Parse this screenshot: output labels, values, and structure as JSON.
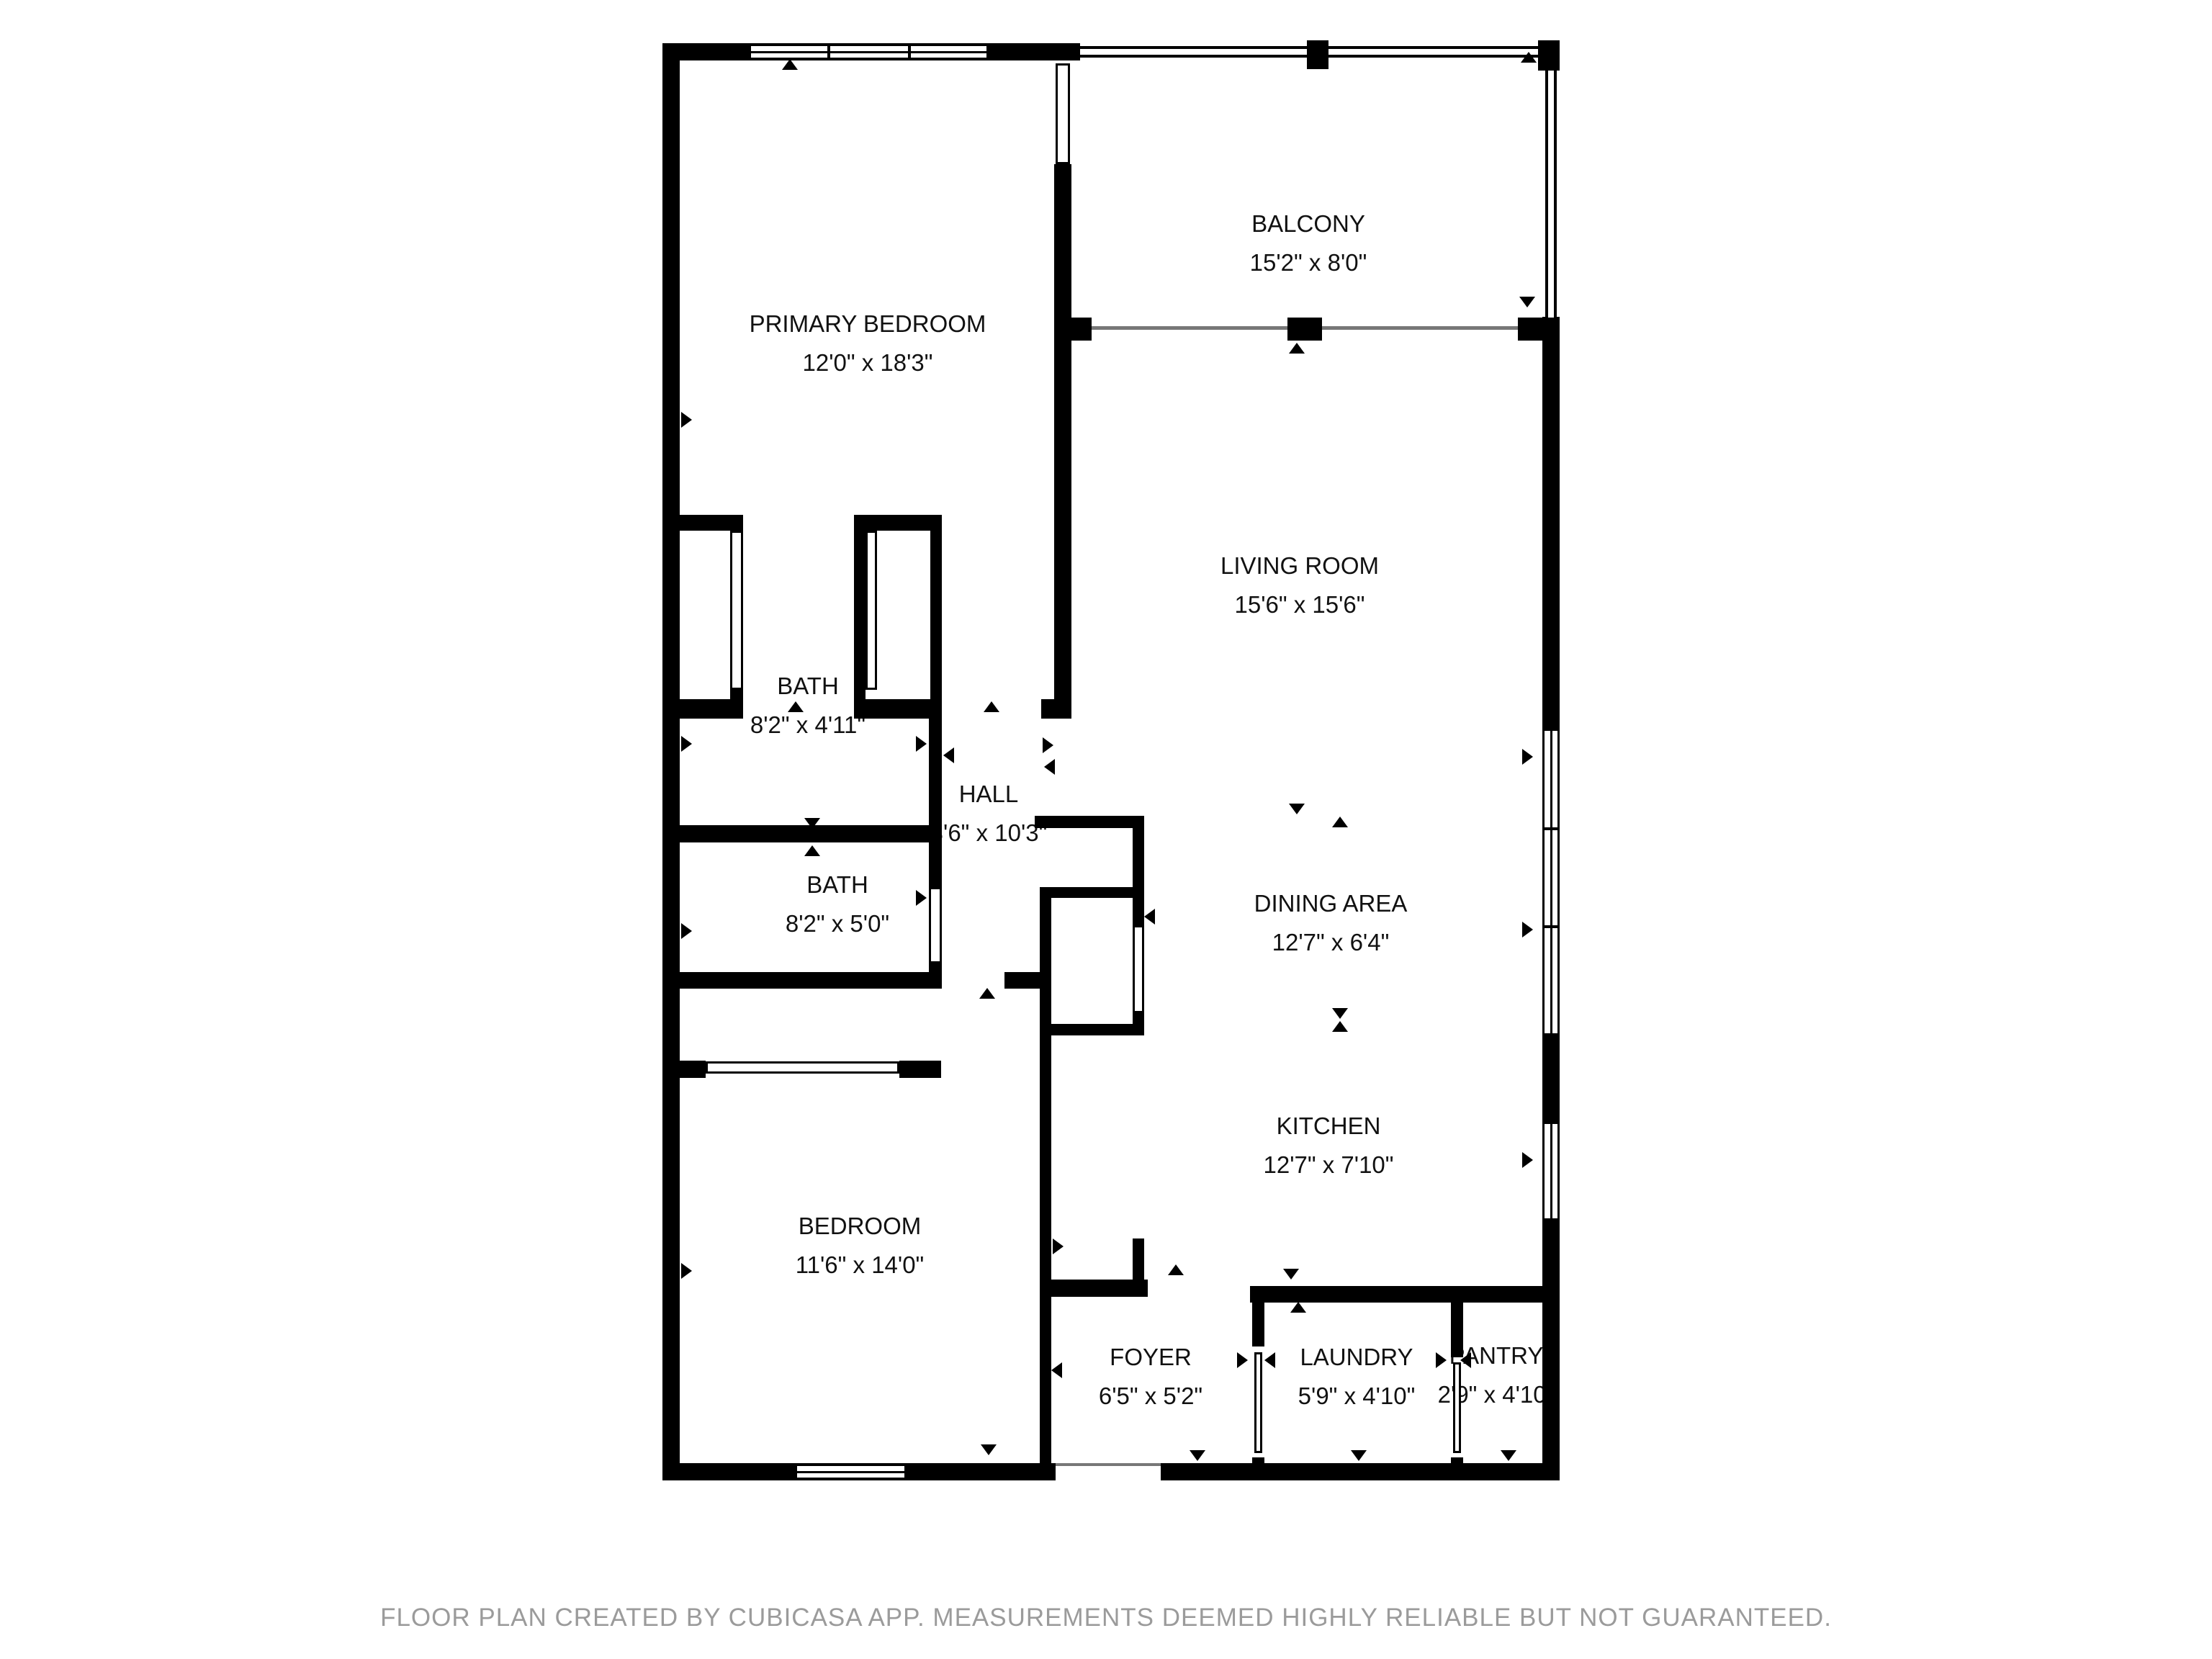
{
  "floor_plan": {
    "footer": "FLOOR PLAN CREATED BY CUBICASA APP. MEASUREMENTS DEEMED HIGHLY RELIABLE BUT NOT GUARANTEED.",
    "colors": {
      "wall": "#000000",
      "background": "#ffffff",
      "footer_text": "#9b9b9b",
      "label_text": "#111111"
    },
    "rooms": [
      {
        "name": "BALCONY",
        "dims": "15'2\" x 8'0\""
      },
      {
        "name": "PRIMARY BEDROOM",
        "dims": "12'0\" x 18'3\""
      },
      {
        "name": "LIVING ROOM",
        "dims": "15'6\" x 15'6\""
      },
      {
        "name": "BATH",
        "dims": "8'2\" x 4'11\""
      },
      {
        "name": "HALL",
        "dims": "3'6\" x 10'3\""
      },
      {
        "name": "BATH",
        "dims": "8'2\" x 5'0\""
      },
      {
        "name": "DINING AREA",
        "dims": "12'7\" x 6'4\""
      },
      {
        "name": "KITCHEN",
        "dims": "12'7\" x 7'10\""
      },
      {
        "name": "BEDROOM",
        "dims": "11'6\" x 14'0\""
      },
      {
        "name": "FOYER",
        "dims": "6'5\" x 5'2\""
      },
      {
        "name": "LAUNDRY",
        "dims": "5'9\" x 4'10\""
      },
      {
        "name": "PANTRY",
        "dims": "2'9\" x 4'10\""
      }
    ]
  }
}
